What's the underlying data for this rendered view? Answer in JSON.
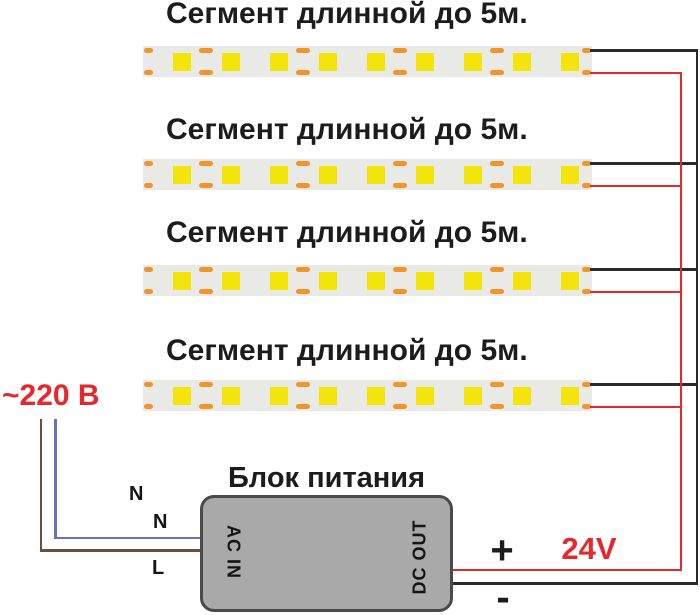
{
  "diagram": {
    "segments": [
      {
        "label": "Сегмент длинной до 5м."
      },
      {
        "label": "Сегмент длинной до 5м."
      },
      {
        "label": "Сегмент длинной до 5м."
      },
      {
        "label": "Сегмент длинной до 5м."
      }
    ],
    "strip": {
      "led_count": 9,
      "cut_mark_pairs": 4
    },
    "power_supply": {
      "title": "Блок питания",
      "input_label": "AC IN",
      "output_label": "DC OUT"
    },
    "labels": {
      "mains_voltage": "~220 В",
      "neutral_1": "N",
      "neutral_2": "N",
      "line": "L",
      "plus": "+",
      "minus": "-",
      "output_voltage": "24V"
    },
    "colors": {
      "wire_positive_red": "#e6272c",
      "wire_negative_black": "#2b2b2b",
      "wire_neutral_blue": "#6673c5",
      "wire_line_brown": "#6b4f3a",
      "led_yellow": "#f3e50c",
      "pad_orange": "#f0952c",
      "strip_body_gray": "#e9e9e6",
      "psu_fill_gray": "#a9a9a9",
      "psu_border_gray": "#4a4a4a",
      "text_black": "#1c1c1c",
      "text_red": "#e6272c"
    }
  }
}
